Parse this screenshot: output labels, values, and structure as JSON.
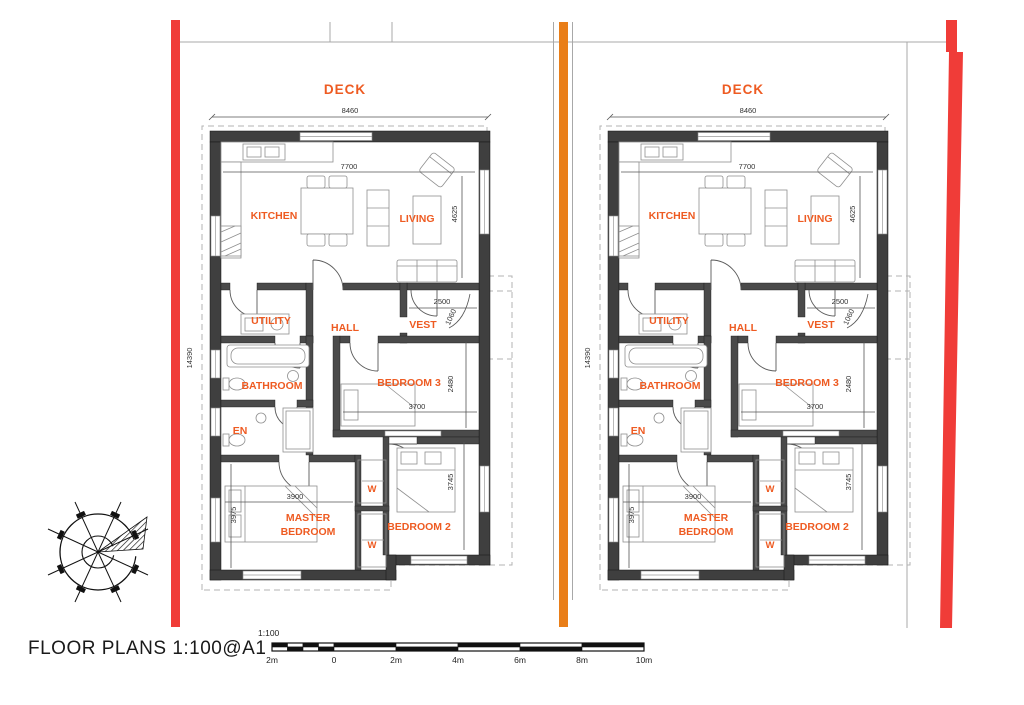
{
  "title": {
    "label": "FLOOR PLANS 1:100@A1"
  },
  "scale_bar": {
    "ratio_label": "1:100",
    "tick_labels": [
      "2m",
      "0",
      "2m",
      "4m",
      "6m",
      "8m",
      "10m"
    ]
  },
  "floor_plan": {
    "deck_label": "DECK",
    "rooms": {
      "kitchen": "KITCHEN",
      "living": "LIVING",
      "utility": "UTILITY",
      "hall": "HALL",
      "vest": "VEST",
      "bathroom": "BATHROOM",
      "bedroom3": "BEDROOM 3",
      "ensuite": "EN",
      "master_line1": "MASTER",
      "master_line2": "BEDROOM",
      "bedroom2": "BEDROOM 2",
      "wardrobe": "W"
    },
    "dimensions": {
      "overall_width": "8460",
      "internal_width": "7700",
      "living_depth": "4625",
      "overall_depth": "14390",
      "vest_width": "2500",
      "vest_depth": "1060",
      "bedroom3_width": "3700",
      "bedroom3_depth": "2480",
      "master_width": "3900",
      "master_depth": "3975",
      "bedroom2_depth": "3745"
    }
  },
  "colors": {
    "label_orange": "#EE5B22",
    "boundary_red": "#F03C38",
    "party_wall_orange": "#E97E18",
    "wall_gray": "#3F3F3F"
  }
}
